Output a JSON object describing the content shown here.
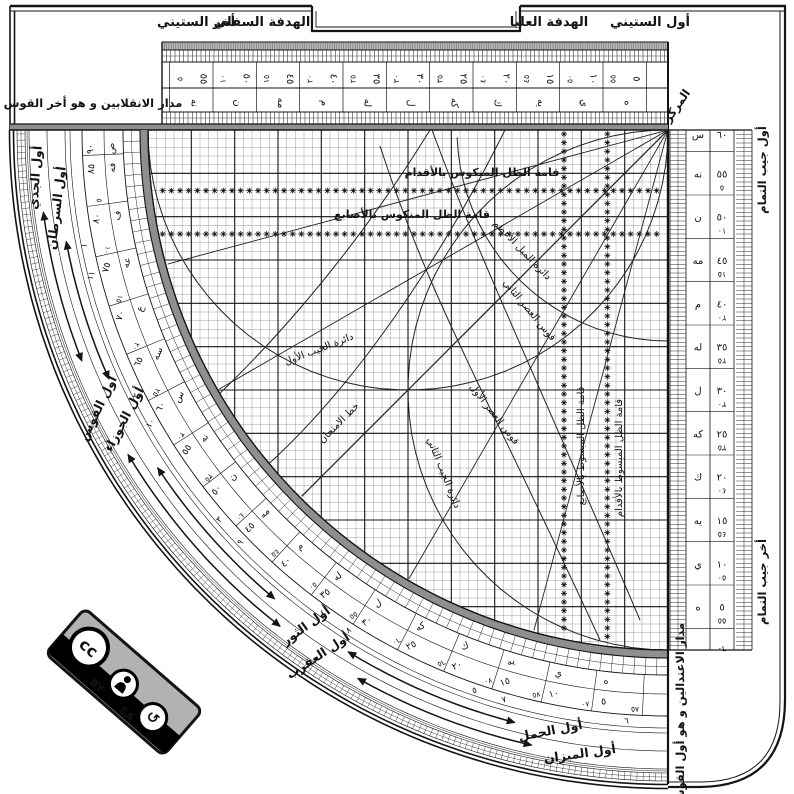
{
  "colors": {
    "ink": "#141414",
    "gray_band": "#8f8f8f",
    "hatch_gray": "#b7b7b7",
    "badge_gray": "#b2b2b2"
  },
  "top_bar": {
    "end_label": "أخر الستيني",
    "lower_sight_label": "الهدفة السفلي",
    "upper_sight_label": "الهدفة العليا",
    "start_label": "أول الستيني"
  },
  "side_labels": {
    "center": "المركز",
    "solstice_line": "مدار الانقلابين و هو أخر القوس",
    "equinox_line": "مدار الاعتدالين و هو أول القوس",
    "cosine_start": "أول جيب التمام",
    "cosine_end": "أخر جيب التمام"
  },
  "grid_labels": {
    "inverted_shadow_feet": "قامة الظل المنكوس بالأقدام",
    "inverted_shadow_digits": "قامة الظل المنكوس بالأصابع",
    "flat_shadow_digits": "قامة الظل المبسوط بالأصابع",
    "flat_shadow_feet": "قامة الظل المبسوط بالأقدام",
    "max_declination": "دائرة الميل الأعظم",
    "first_sine_circle": "دائرة الجيب الأول",
    "second_sine_circle": "دائرة الجيب الثاني",
    "first_asr_arc": "قوس العصر الأول",
    "second_asr_arc": "قوس العصر الثاني",
    "test_line": "خط الامتحان"
  },
  "zodiac": {
    "capricorn": "أول الجدي",
    "cancer": "أول السرطان",
    "sagittarius": "أول القوس",
    "gemini": "أول الجوزاء",
    "scorpio": "أول العقرب",
    "taurus": "أول الثور",
    "libra": "أول الميزان",
    "aries": "أول الحمل"
  },
  "scales": {
    "numerals_5_60": [
      "٥",
      "١٠",
      "١٥",
      "٢٠",
      "٢٥",
      "٣٠",
      "٣٥",
      "٤٠",
      "٤٥",
      "٥٠",
      "٥٥",
      "٦٠"
    ],
    "abjad_5_60": [
      "ه",
      "ي",
      "يه",
      "ك",
      "كه",
      "ل",
      "له",
      "م",
      "مه",
      "ن",
      "نه",
      "س"
    ],
    "numerals_65_90": [
      "٦٥",
      "٧٠",
      "٧٥",
      "٨٠",
      "٨٥",
      "٩٠"
    ],
    "abjad_65_90": [
      "سه",
      "ع",
      "عه",
      "ف",
      "فه",
      "ص"
    ],
    "hours_pairs": [
      [
        "١",
        "١١"
      ],
      [
        "٢",
        "١٠"
      ],
      [
        "٣",
        "٩"
      ],
      [
        "٤",
        "٨"
      ],
      [
        "٥",
        "٧"
      ],
      [
        "٦"
      ]
    ]
  },
  "badge": {
    "cc_label": "cc",
    "by_label": "BY",
    "sa_label": "SA"
  }
}
